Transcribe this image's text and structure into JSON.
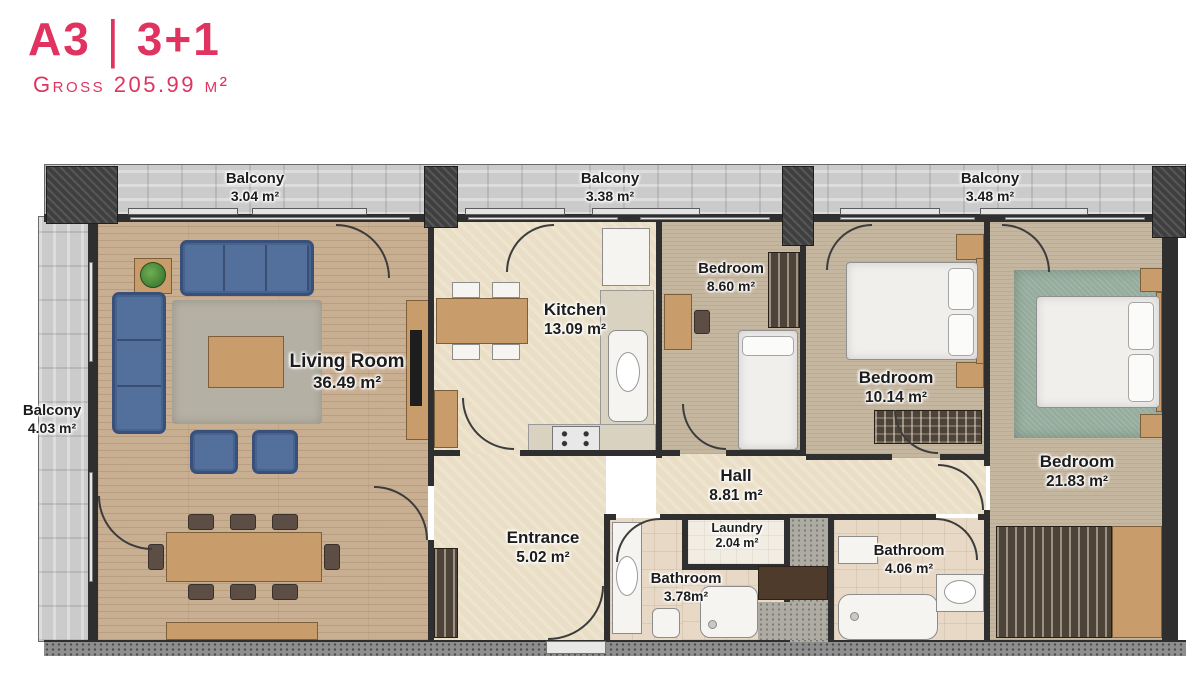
{
  "header": {
    "unit": "A3",
    "separator": "|",
    "layout_type": "3+1",
    "gross": "Gross 205.99 m²"
  },
  "rooms": {
    "balcony_top_left": {
      "name": "Balcony",
      "area": "3.04 m²"
    },
    "balcony_top_middle": {
      "name": "Balcony",
      "area": "3.38 m²"
    },
    "balcony_top_right": {
      "name": "Balcony",
      "area": "3.48 m²"
    },
    "balcony_left": {
      "name": "Balcony",
      "area": "4.03 m²"
    },
    "living_room": {
      "name": "Living Room",
      "area": "36.49 m²"
    },
    "kitchen": {
      "name": "Kitchen",
      "area": "13.09 m²"
    },
    "bedroom_small": {
      "name": "Bedroom",
      "area": "8.60 m²"
    },
    "bedroom_middle": {
      "name": "Bedroom",
      "area": "10.14 m²"
    },
    "bedroom_large": {
      "name": "Bedroom",
      "area": "21.83 m²"
    },
    "hall": {
      "name": "Hall",
      "area": "8.81 m²"
    },
    "entrance": {
      "name": "Entrance",
      "area": "5.02 m²"
    },
    "laundry": {
      "name": "Laundry",
      "area": "2.04 m²"
    },
    "bathroom_small": {
      "name": "Bathroom",
      "area": "3.78m²"
    },
    "bathroom_large": {
      "name": "Bathroom",
      "area": "4.06 m²"
    }
  },
  "colors": {
    "accent": "#E0335F",
    "wall": "#2F2F2F",
    "wood_floor": "#C9AF92",
    "balcony_floor": "#CBCBCB",
    "cream_floor": "#EADFC6",
    "carpet_floor": "#C5B6A0",
    "sofa_blue": "#53709C",
    "rug_green": "#96AD9D"
  }
}
